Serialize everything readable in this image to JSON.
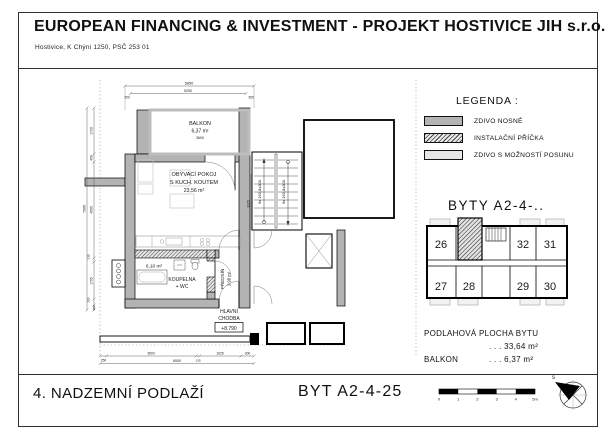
{
  "header": {
    "title": "EUROPEAN FINANCING & INVESTMENT - PROJEKT HOSTIVICE JIH s.r.o.",
    "address": "Hostivice, K Chýni 1250, PSČ 253 01"
  },
  "legend": {
    "title": "LEGENDA :",
    "items": [
      {
        "label": "ZDIVO NOSNÉ",
        "style": "solid"
      },
      {
        "label": "INSTALAČNÍ PŘÍČKA",
        "style": "hatched"
      },
      {
        "label": "ZDIVO S MOŽNOSTÍ POSUNU",
        "style": "light"
      }
    ]
  },
  "overview": {
    "title": "BYTY  A2-4-..",
    "units": {
      "u26": "26",
      "u27": "27",
      "u28": "28",
      "u29": "29",
      "u30": "30",
      "u31": "31",
      "u32": "32"
    }
  },
  "summary": {
    "floor_area_label": "PODLAHOVÁ PLOCHA BYTU",
    "floor_area_value": ". . .  33,64 m²",
    "balcony_label": "BALKON",
    "balcony_value": ". . .   6,37 m²"
  },
  "title_block": {
    "floor_title": "4. NADZEMNÍ PODLAŽÍ",
    "unit_title": "BYT  A2-4-25"
  },
  "scale_bar": {
    "ticks": [
      "0",
      "1",
      "2",
      "3",
      "4",
      "5m"
    ]
  },
  "compass": {
    "north": "s"
  },
  "colors": {
    "wall": "#b3b3b3",
    "hatch_line": "#333333",
    "drawing_line": "#1a1a1a"
  },
  "plan": {
    "rooms": {
      "balcony": {
        "name": "BALKON",
        "area": "6,37 m²",
        "width_dim": "3600"
      },
      "living": {
        "line1": "OBÝVACÍ POKOJ",
        "line2": "S KUCH. KOUTEM",
        "area": "23,56 m²"
      },
      "bathroom": {
        "area": "6,10 m²",
        "line1": "KOUPELNA",
        "line2": "+ WC"
      },
      "entry_hall": {
        "name": "PŘEDSÍŇ",
        "area": "3,98 m²"
      },
      "main_corridor": {
        "line1": "HLAVNÍ",
        "line2": "CHODBA",
        "level": "+8.790"
      }
    },
    "stairs": {
      "flight_label": "9x 162,8x300"
    },
    "dims": {
      "top_total": "5850",
      "top_span": "5250",
      "top_left": "250",
      "top_right": "350",
      "left_total": "7005",
      "left": [
        "1730",
        "400",
        "4500",
        "135",
        "1795",
        "250",
        "150"
      ],
      "bottom": [
        "250",
        "3500",
        "135",
        "1625",
        "300"
      ],
      "bottom_total": "6000",
      "stair_side": "3225"
    }
  }
}
